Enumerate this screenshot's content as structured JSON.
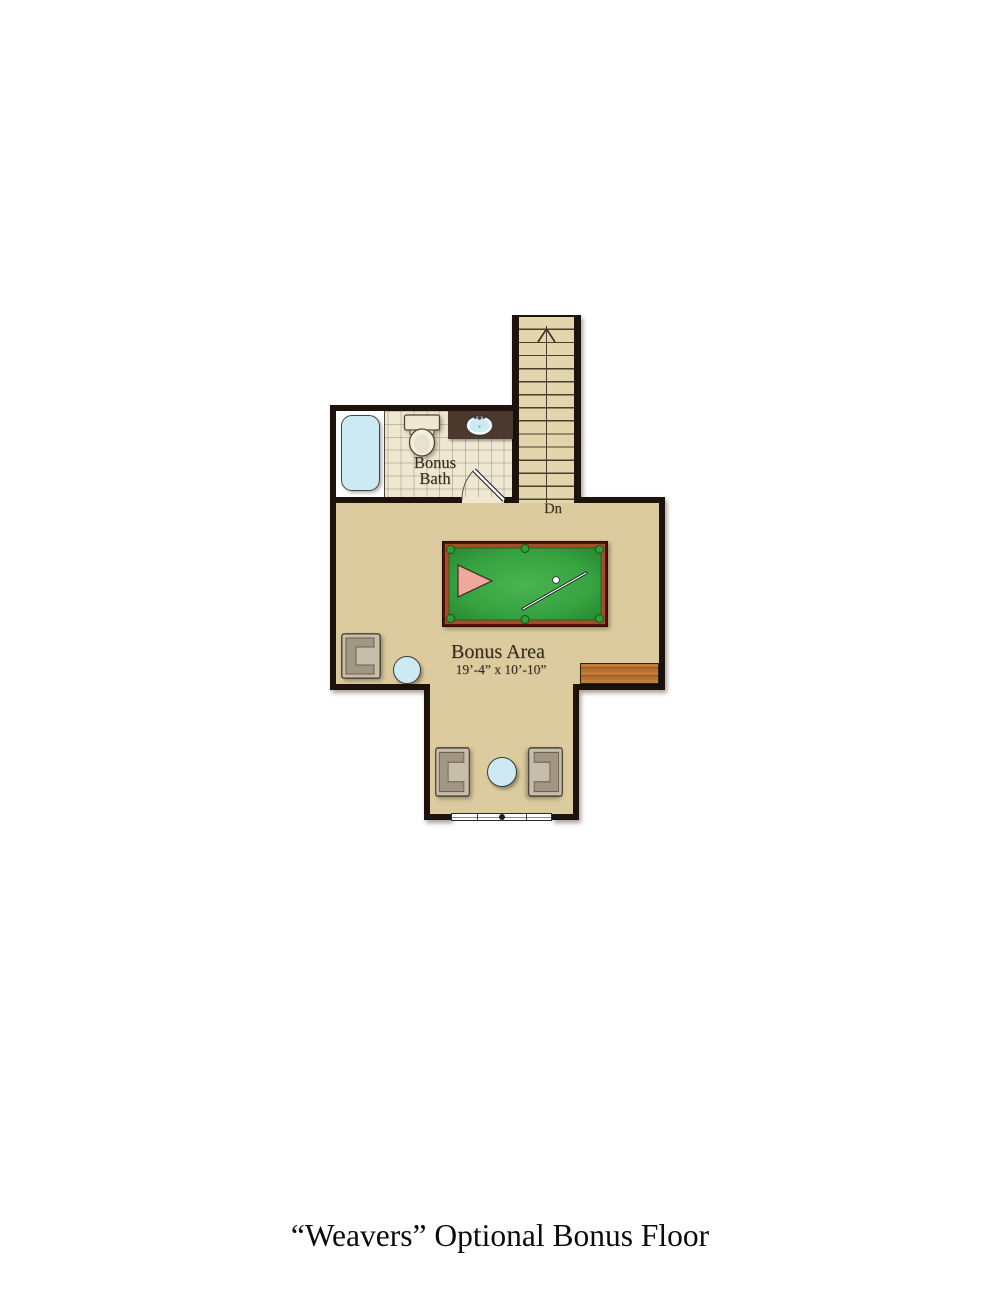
{
  "page": {
    "background": "#ffffff",
    "title": "“Weavers” Optional Bonus Floor"
  },
  "plan": {
    "bath": {
      "name_line1": "Bonus",
      "name_line2": "Bath"
    },
    "stairs": {
      "label": "Dn",
      "visible_steps": 14,
      "direction_icon": "up-arrow"
    },
    "bonus_area": {
      "name": "Bonus Area",
      "dimensions": "19’-4” x 10’-10”"
    }
  },
  "colors": {
    "wall": "#1d130c",
    "floor": "#dccb9e",
    "tile": "#eee7d2",
    "stair": "#e4d6ac",
    "tread": "#4a3e2c",
    "water": "#cde9f4",
    "vanity": "#4b392d",
    "rail": "#6f1408",
    "felt": "#36a340",
    "wood": "#b5732f",
    "chair": "#b3a795",
    "label": "#362c1e"
  }
}
